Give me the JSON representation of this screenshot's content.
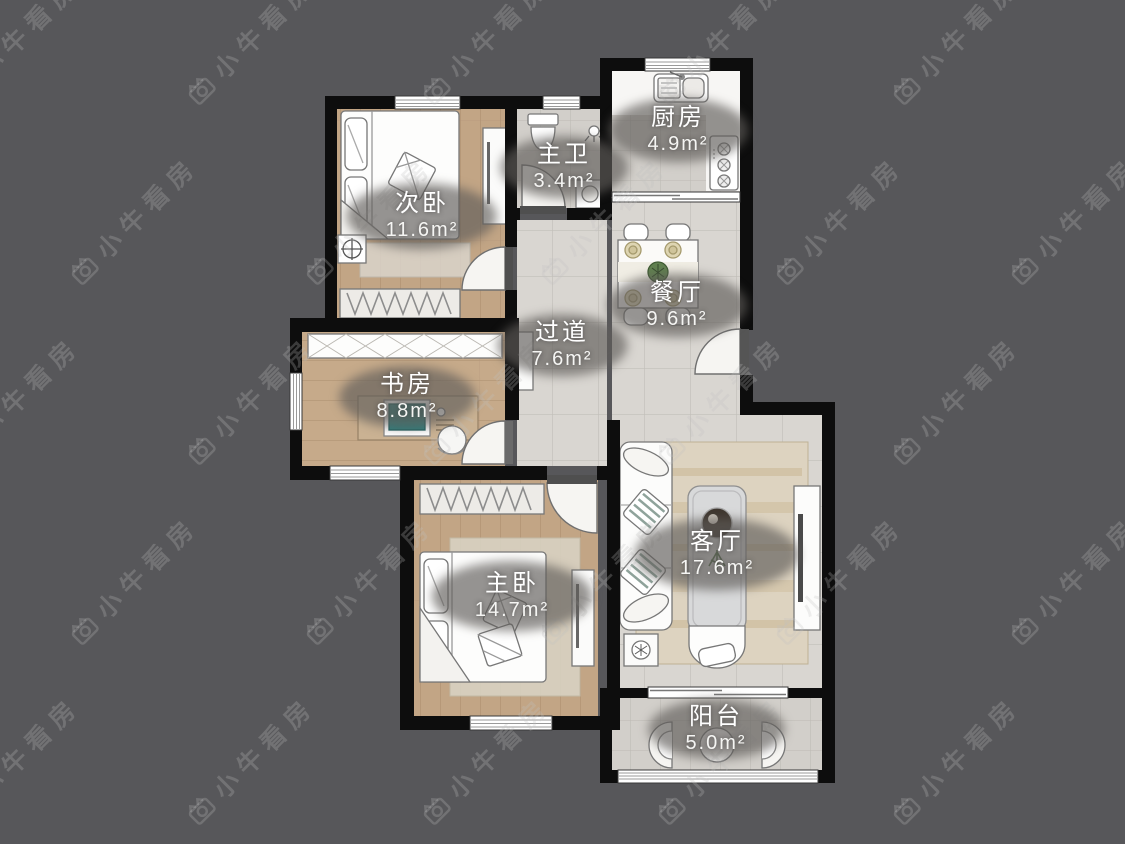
{
  "watermark": {
    "text": "小牛看房"
  },
  "rooms": [
    {
      "name": "次卧",
      "area": "11.6m²"
    },
    {
      "name": "主卫",
      "area": "3.4m²"
    },
    {
      "name": "厨房",
      "area": "4.9m²"
    },
    {
      "name": "餐厅",
      "area": "9.6m²"
    },
    {
      "name": "过道",
      "area": "7.6m²"
    },
    {
      "name": "书房",
      "area": "8.8m²"
    },
    {
      "name": "主卧",
      "area": "14.7m²"
    },
    {
      "name": "客厅",
      "area": "17.6m²"
    },
    {
      "name": "阳台",
      "area": "5.0m²"
    }
  ]
}
